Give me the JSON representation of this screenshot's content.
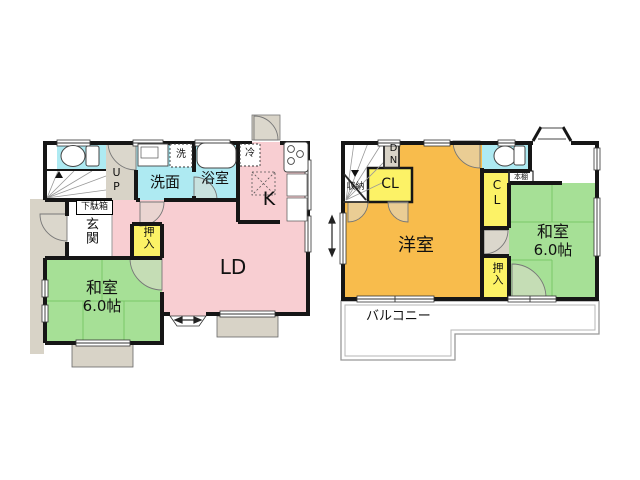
{
  "plan": {
    "floor1": {
      "up_label": "UP",
      "washroom": "洗面",
      "washer": "洗",
      "bathroom": "浴室",
      "fridge": "冷",
      "kitchen": "K",
      "living_dining": "LD",
      "shoe_box": "下駄箱",
      "entrance": "玄関",
      "closet": "押入",
      "japanese_room": "和室",
      "japanese_room_size": "6.0帖"
    },
    "floor2": {
      "down_label": "DN",
      "storage": "収納",
      "closet_top": "CL",
      "closet_mid": "CL",
      "bookshelf": "本棚",
      "western_room": "洋室",
      "japanese_room": "和室",
      "japanese_room_size": "6.0帖",
      "closet": "押入",
      "balcony": "バルコニー"
    },
    "colors": {
      "wall": "#161616",
      "water_rooms": "#aeeaf2",
      "ld_kitchen": "#f8ced2",
      "japanese_room": "#a6e096",
      "western_room": "#f8bc4c",
      "closet": "#fcf266",
      "porch": "#d8d3c7"
    }
  }
}
